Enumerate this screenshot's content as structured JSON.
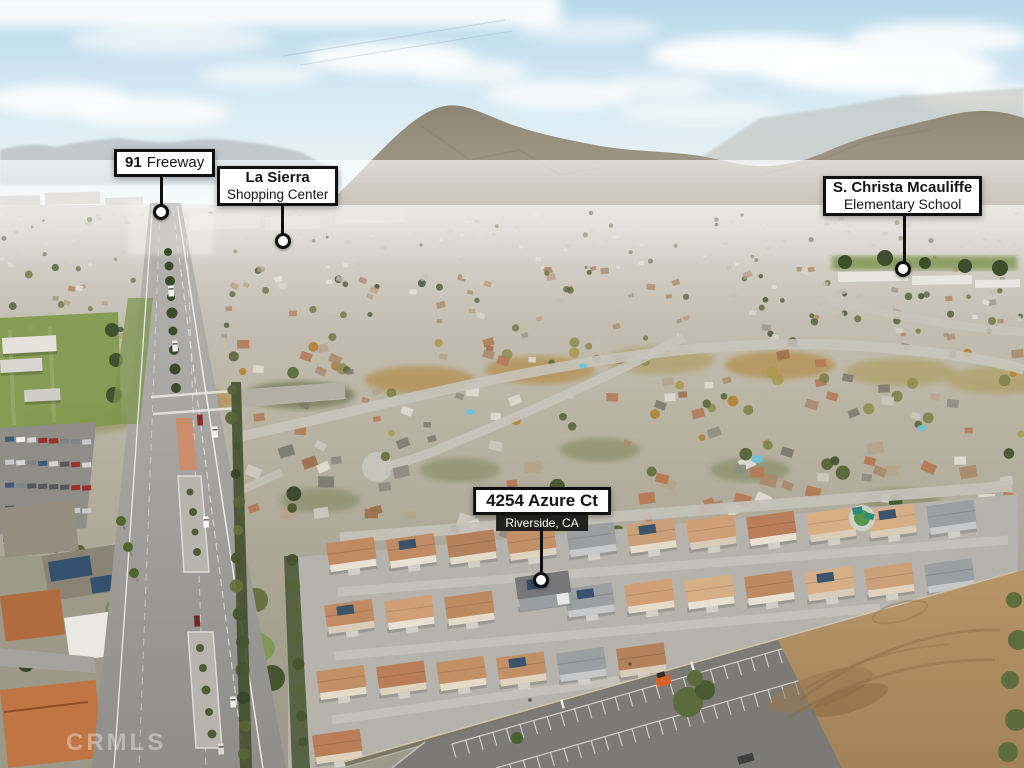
{
  "photo": {
    "watermark": "CRMLS"
  },
  "callouts": {
    "freeway": {
      "number": "91",
      "name": "Freeway"
    },
    "shopping": {
      "line1": "La Sierra",
      "line2": "Shopping Center"
    },
    "school": {
      "line1": "S. Christa Mcauliffe",
      "line2": "Elementary School"
    },
    "property": {
      "address": "4254 Azure Ct",
      "city": "Riverside, CA"
    }
  },
  "palette": {
    "label_background": "#ffffff",
    "label_border": "#101010",
    "city_chip_background": "#161616",
    "city_chip_text": "#ffffff",
    "marker_fill": "#ffffff",
    "median_red": "#d08a66",
    "dirt_tan": "#b6946b"
  }
}
